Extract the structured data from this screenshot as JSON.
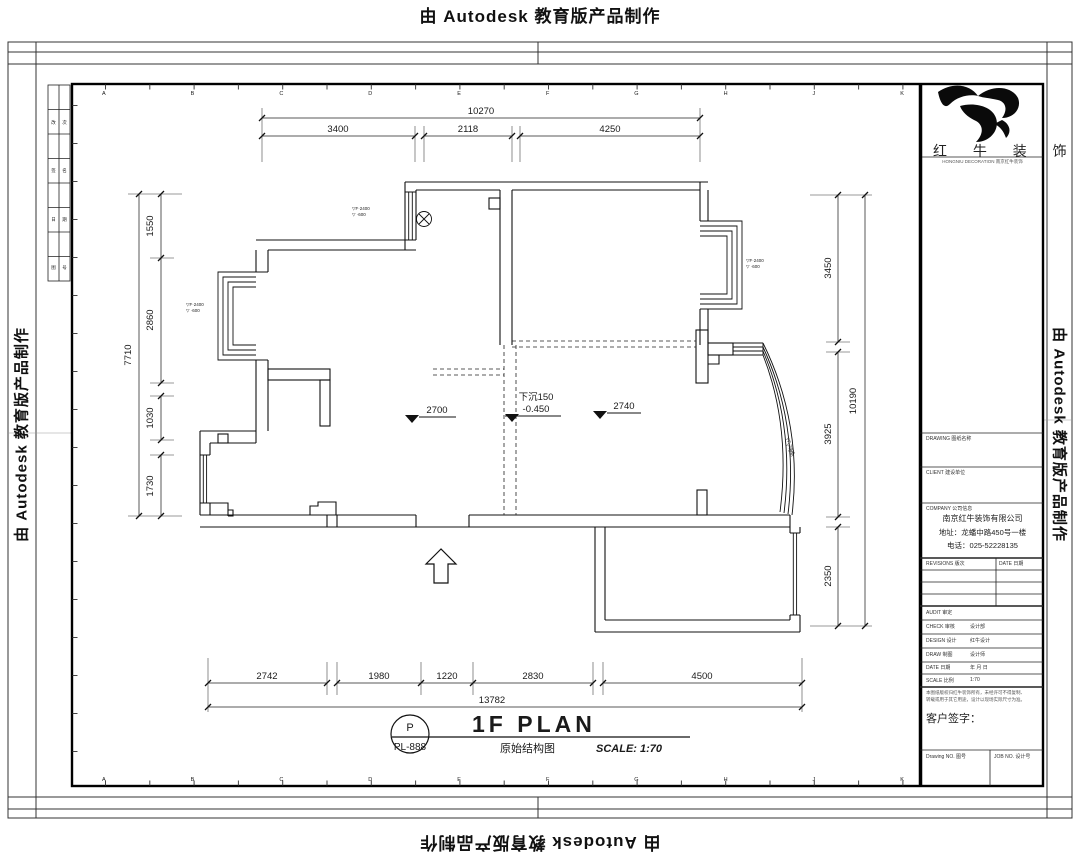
{
  "watermark": {
    "text": "由 Autodesk 教育版产品制作"
  },
  "sheet": {
    "grid_letters": "ABCDEFGHJK"
  },
  "strip_table": {
    "cells": [
      [
        "改",
        "次"
      ],
      [
        "签",
        "名"
      ],
      [
        "日",
        "期"
      ],
      [
        "图",
        "号"
      ]
    ]
  },
  "title_block": {
    "logo_title": "红 牛 装 饰",
    "logo_sub": "HONGNIU DECORATION 南京红牛装饰",
    "row_labels": {
      "r1": "DRAWING 图纸名称",
      "r2": "CLIENT 建设单位",
      "r3": "COMPANY 公司信息"
    },
    "company": {
      "name": "南京红牛装饰有限公司",
      "address": "地址：龙蟠中路450号一楼",
      "phone": "电话：025-52228135"
    },
    "rev": {
      "col1": "REVISIONS 版次",
      "col2": "DATE 日期"
    },
    "fields": [
      {
        "label": "AUDIT 审定",
        "value": ""
      },
      {
        "label": "CHECK 审核",
        "value": "设计部"
      },
      {
        "label": "DESIGN 设计",
        "value": "红牛设计"
      },
      {
        "label": "DRAW 制图",
        "value": "设计师"
      },
      {
        "label": "DATE 日期",
        "value": "年 月 日"
      },
      {
        "label": "SCALE 比例",
        "value": "1:70"
      }
    ],
    "notes": [
      "本图纸版权归红牛装饰所有，未经许可不得复制、",
      "转载或用于其它用途，设计以现场实际尺寸为准。"
    ],
    "customer_sign": "客户签字：",
    "bottom": {
      "left": "Drawing NO. 图号",
      "right": "JOB NO. 设计号"
    }
  },
  "plan": {
    "dims": {
      "top": {
        "total": "10270",
        "segments": [
          "3400",
          "2118",
          "4250"
        ]
      },
      "left": {
        "total": "7710",
        "segments": [
          "1550",
          "2860",
          "1030",
          "1730"
        ]
      },
      "right": {
        "total": "10190",
        "segments": [
          "3450",
          "3925",
          "2350"
        ]
      },
      "bottom": {
        "total": "13782",
        "segments": [
          "2742",
          "1980",
          "1220",
          "2830",
          "4500"
        ]
      }
    },
    "levels": {
      "ceil_left": "2700",
      "ceil_right": "2740",
      "sunken": "下沉150",
      "sunken_level": "-0.450"
    },
    "window_notes": {
      "n1": "▽F·2400",
      "n2": "▽ ·600"
    },
    "titlebar": {
      "bubble_top": "P",
      "bubble_bottom": "PL-888",
      "name": "1F PLAN",
      "subtitle": "原始结构图",
      "scale": "SCALE: 1:70"
    }
  }
}
